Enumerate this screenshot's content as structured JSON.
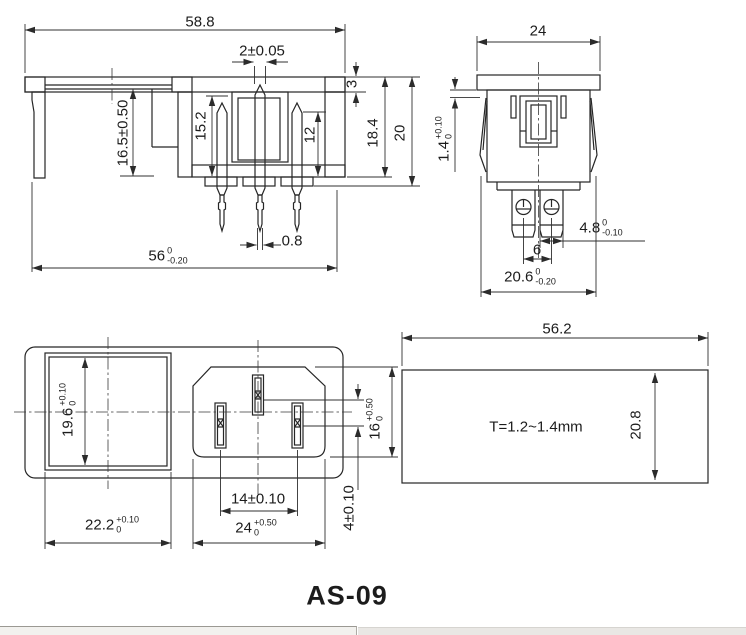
{
  "title": "AS-09",
  "views": {
    "side_section": {
      "overall_width": "58.8",
      "contact_slot": "2±0.05",
      "flange_thickness": "3",
      "body_depth": "18.4",
      "overall_depth": "20",
      "cavity_depth": "15.2",
      "pin_depth": "12",
      "mount_depth": "16.5±0.50",
      "pin_thickness": "0.8",
      "body_width": {
        "value": "56",
        "tol_upper": "0",
        "tol_lower": "-0.20"
      }
    },
    "front_view": {
      "flange_width": "24",
      "flange_lip": {
        "value": "1.4",
        "tol_upper": "+0.10",
        "tol_lower": "0"
      },
      "terminal_width": {
        "value": "4.8",
        "tol_upper": "0",
        "tol_lower": "-0.10"
      },
      "terminal_pitch": "6",
      "body_width": {
        "value": "20.6",
        "tol_upper": "0",
        "tol_lower": "-0.20"
      }
    },
    "face_view": {
      "cutout_height": {
        "value": "19.6",
        "tol_upper": "+0.10",
        "tol_lower": "0"
      },
      "cutout_width": {
        "value": "22.2",
        "tol_upper": "+0.10",
        "tol_lower": "0"
      },
      "pin_pitch": "14±0.10",
      "socket_width": {
        "value": "24",
        "tol_upper": "+0.50",
        "tol_lower": "0"
      },
      "socket_height": {
        "value": "16",
        "tol_upper": "+0.50",
        "tol_lower": "0"
      },
      "pin_offset": "4±0.10"
    },
    "panel_cutout": {
      "width": "56.2",
      "height": "20.8",
      "panel_thickness": "T=1.2~1.4mm"
    }
  }
}
